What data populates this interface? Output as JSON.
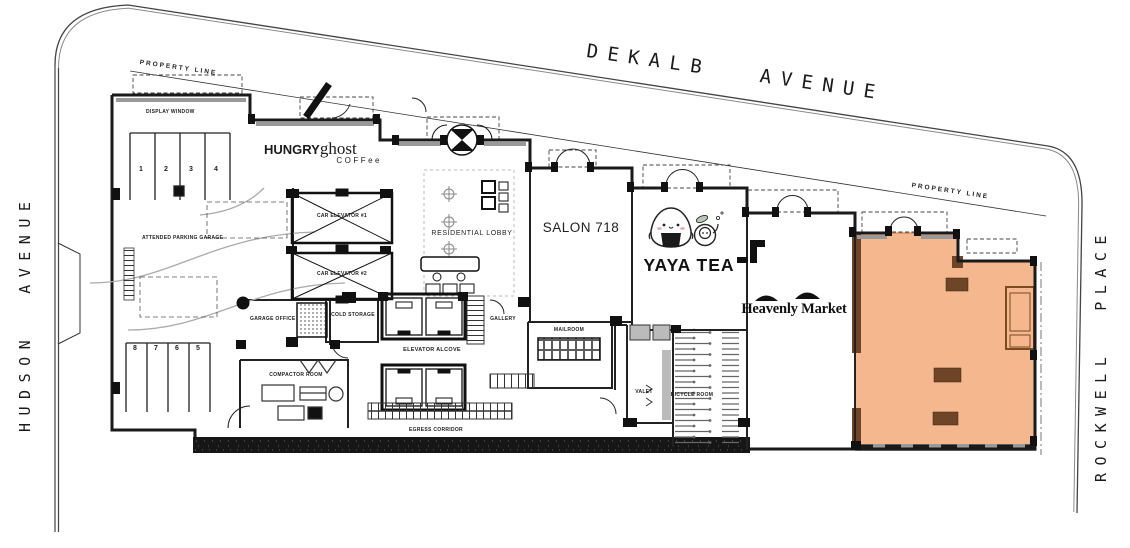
{
  "streets": {
    "top": "DEKALB AVENUE",
    "left": "HUDSON AVENUE",
    "right": "ROCKWELL PLACE"
  },
  "property_line_label": "PROPERTY LINE",
  "rooms": {
    "display_window": "DISPLAY WINDOW",
    "attended_parking_garage": "ATTENDED PARKING GARAGE",
    "garage_office": "GARAGE OFFICE",
    "car_elevator_1": "CAR ELEVATOR #1",
    "car_elevator_2": "CAR ELEVATOR #2",
    "residential_lobby": "RESIDENTIAL LOBBY",
    "cold_storage": "COLD STORAGE",
    "elevator_alcove": "ELEVATOR ALCOVE",
    "gallery": "GALLERY",
    "mailroom": "MAILROOM",
    "compactor_room": "COMPACTOR ROOM",
    "egress_corridor": "EGRESS CORRIDOR",
    "valet": "VALET",
    "bicycle_room": "BICYCLE ROOM"
  },
  "tenants": {
    "hungry_ghost": {
      "word1": "HUNGRY",
      "word2": "ghost",
      "sub": "COFFee"
    },
    "salon_718": {
      "name": "SALON 718"
    },
    "yaya_tea": {
      "name": "YAYA TEA"
    },
    "heavenly_market": {
      "name": "Heavenly Market"
    }
  },
  "parking": {
    "top_row": [
      "1",
      "2",
      "3",
      "4"
    ],
    "bottom_row": [
      "8",
      "7",
      "6",
      "5"
    ]
  },
  "colors": {
    "highlight_fill": "#F5B78E",
    "highlight_trim": "#6F4527",
    "wall": "#1A1A1A",
    "street_line": "#444444"
  }
}
